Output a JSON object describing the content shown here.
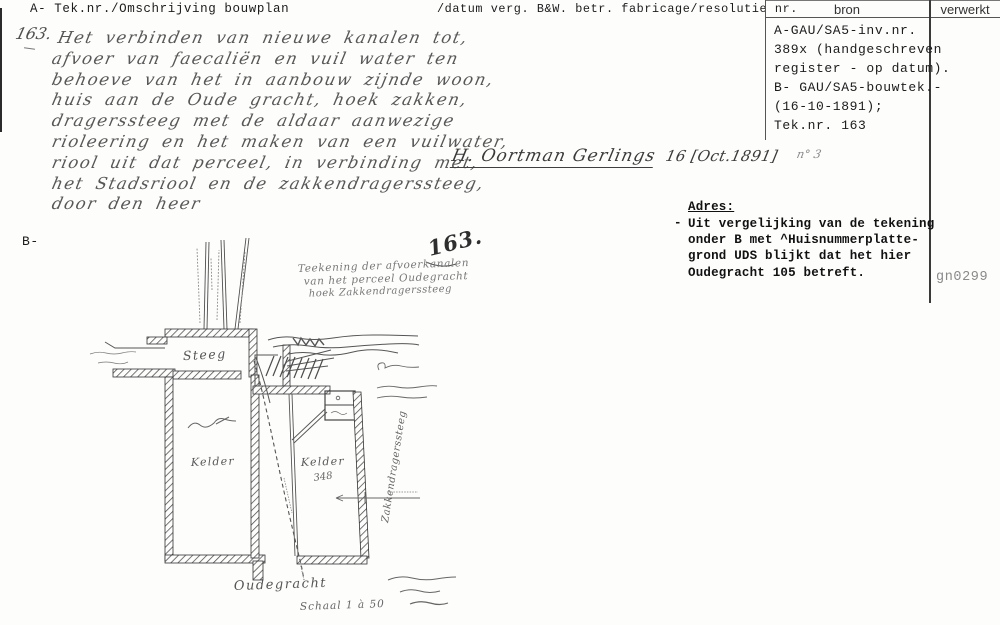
{
  "header": {
    "col_a": "A- Tek.nr./Omschrijving bouwplan",
    "col_datum": "/datum verg. B&W. betr. fabricage/resolutie nr.",
    "col_bron": "bron",
    "col_verwerkt": "verwerkt"
  },
  "bron_box": {
    "lines": [
      "A-GAU/SA5-inv.nr.",
      "389x (handgeschreven",
      "register - op datum).",
      "B- GAU/SA5-bouwtek.-",
      "(16-10-1891);",
      "Tek.nr. 163"
    ]
  },
  "verwerkt_code": "gn0299",
  "description": {
    "number": "163.",
    "lines": [
      "Het verbinden van nieuwe kanalen tot,",
      "afvoer van faecaliën en vuil water ten",
      "behoeve van het in aanbouw zijnde woon,",
      "huis aan de Oude gracht, hoek zakken,",
      "dragerssteeg met de aldaar aanwezige",
      "rioleering en het maken van een vuilwater,",
      "riool uit dat perceel, in verbinding met,",
      "het Stadsriool en de zakkendragerssteeg,",
      "door den heer"
    ]
  },
  "signature": {
    "name": "H. Oortman Gerlings",
    "date": "16 [Oct.1891]",
    "note": "n° 3"
  },
  "adres": {
    "heading": "Adres:",
    "bullet": "-",
    "lines": [
      "Uit vergelijking van de tekening",
      "onder B met ^Huisnummerplatte-",
      "grond UDS blijkt dat het hier",
      "Oudegracht 105 betreft."
    ]
  },
  "section_b_label": "B-",
  "drawing": {
    "number": "163.",
    "title_lines": [
      "Teekening der afvoerkanalen",
      "van het perceel Oudegracht",
      "hoek Zakkendragerssteeg"
    ],
    "labels": {
      "steeg": "Steeg",
      "kelder_left": "Kelder",
      "kelder_right": "Kelder",
      "kelder_right_number": "348",
      "street_vertical": "Zakkendragerssteeg",
      "oudegracht": "Oudegracht",
      "scale": "Schaal 1 à 50"
    }
  },
  "colors": {
    "ink": "#1c1c1c",
    "pencil": "#575757",
    "paper": "#fdfdfc",
    "faded": "#8a8a8a"
  }
}
